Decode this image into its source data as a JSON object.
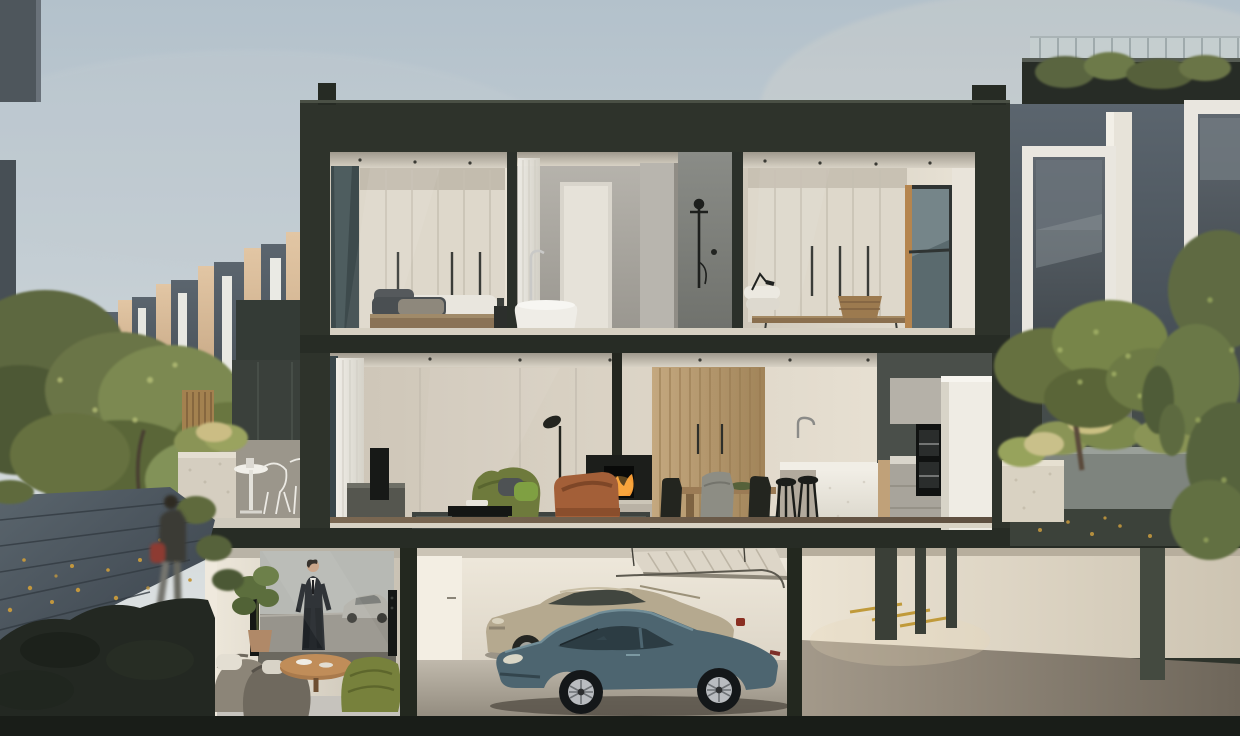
{
  "scene": {
    "type": "architectural-cutaway-render",
    "subject": "three-storey townhouse cross-section at dusk",
    "levels": [
      {
        "name": "top-floor",
        "rooms": [
          {
            "name": "bedroom-1",
            "objects": [
              "window",
              "cream-wardrobe",
              "bed-with-throw",
              "bedside-table",
              "downlights"
            ]
          },
          {
            "name": "bathroom",
            "objects": [
              "sheer-curtain",
              "freestanding-bath",
              "floor-faucet",
              "stone-feature-wall",
              "black-shower-set"
            ]
          },
          {
            "name": "bedroom-2",
            "objects": [
              "cream-wardrobe",
              "desk-lamp",
              "pillows",
              "timber-bench",
              "woven-basket",
              "corner-window"
            ]
          }
        ]
      },
      {
        "name": "living-floor",
        "rooms": [
          {
            "name": "living-room",
            "objects": [
              "sheer-curtain",
              "tv-unit",
              "green-fabric-sofa",
              "black-coffee-table",
              "striped-rug",
              "floor-lamp",
              "leather-armchair",
              "wood-burner-fireplace"
            ]
          },
          {
            "name": "dining",
            "objects": [
              "timber-feature-wall",
              "dining-table",
              "black-chairs",
              "covered-chair",
              "green-bowl"
            ]
          },
          {
            "name": "kitchen",
            "objects": [
              "stone-island",
              "tall-faucet",
              "bar-stools",
              "wall-ovens",
              "pantry-monolith",
              "rear-garden-opening"
            ]
          }
        ]
      },
      {
        "name": "basement",
        "rooms": [
          {
            "name": "media-room",
            "objects": [
              "projector-screen-movie-still",
              "tower-speakers",
              "fiddle-leaf-plant",
              "bean-bag-sofas",
              "round-timber-table",
              "green-ottoman"
            ]
          },
          {
            "name": "garage",
            "objects": [
              "open-sectional-door",
              "two-cars"
            ]
          },
          {
            "name": "driveway",
            "objects": [
              "concrete-columns",
              "yellow-parking-markings",
              "ramp-floor"
            ]
          }
        ]
      }
    ],
    "vehicles": [
      {
        "name": "porsche-911-coupe",
        "color": "#4d6570"
      },
      {
        "name": "bentley-coupe",
        "color": "#b5a98f"
      }
    ],
    "screen_media": "movie still: man in dark suit beside silver classic car",
    "exterior": {
      "left": [
        "receding-townhouse-row",
        "street-trees",
        "timber-boardwalk-with-autumn-leaves",
        "pedestrian",
        "neighbour-terrace-with-wire-chairs",
        "stone-planter",
        "timber-fence"
      ],
      "right": [
        "neighbour-house-white-window-frames",
        "roof-garden-balustrade",
        "concrete-planter-wall",
        "grasses",
        "large-tree",
        "climbing-vine"
      ]
    },
    "time_of_day": "dusk-overcast"
  },
  "palette": {
    "sky_top": "#b3c1cb",
    "sky_bottom": "#e4e7e6",
    "structure": "#2e332b",
    "interior_wall": "#ddd6c9",
    "wardrobe": "#ded8cb",
    "stone_grey": "#8f908c",
    "timber_wall": "#b1946c",
    "timber_floor": "#6e5c49",
    "island_white": "#eae7df",
    "sofa_green": "#6e7a3c",
    "ottoman_green": "#77813c",
    "leather": "#a35f38",
    "fire": "#f59b35",
    "rug": "#3e433f",
    "screen_sky": "#b7b9b4",
    "suit_dark": "#24282c",
    "garage_wall": "#e9e2d4",
    "garage_floor": "#b0a89a",
    "marking_yellow": "#c09a3a",
    "leaves_autumn": "#c2973e",
    "foliage": "#6a7547",
    "foliage_light": "#8a9a5e",
    "neighbor_face": "#4d565e",
    "neighbor_lit": "#cdb193",
    "frame_white": "#e9e6df",
    "planter_stone": "#d5cec0",
    "path_board": "#49525a",
    "red_accent": "#8d3b30"
  }
}
